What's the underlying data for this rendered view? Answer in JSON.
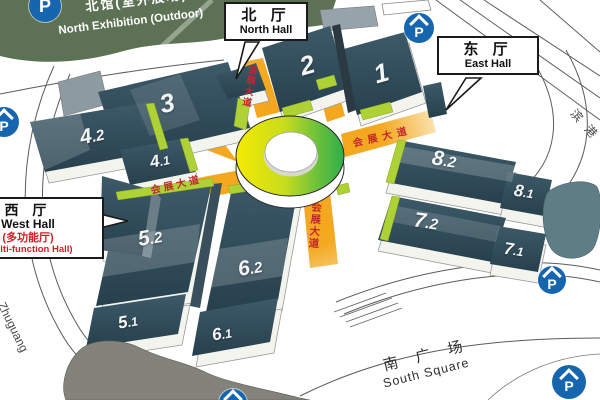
{
  "areas": {
    "north_outdoor": {
      "cn": "北馆(室外展场)",
      "en": "North Exhibition (Outdoor)"
    },
    "south_square": {
      "cn": "南 广 场",
      "en": "South Square"
    }
  },
  "callouts": {
    "north": {
      "cn": "北 厅",
      "en": "North Hall"
    },
    "east": {
      "cn": "东 厅",
      "en": "East Hall"
    },
    "west": {
      "cn": "西 厅",
      "en": "West Hall",
      "note_cn": "(多功能厅)",
      "note_en": "(Multi-function Hall)"
    }
  },
  "halls": [
    {
      "main": "1",
      "sub": ""
    },
    {
      "main": "2",
      "sub": ""
    },
    {
      "main": "3",
      "sub": ""
    },
    {
      "main": "4",
      "sub": ".2"
    },
    {
      "main": "4",
      "sub": ".1"
    },
    {
      "main": "5",
      "sub": ".2"
    },
    {
      "main": "5",
      "sub": ".1"
    },
    {
      "main": "6",
      "sub": ".2"
    },
    {
      "main": "6",
      "sub": ".1"
    },
    {
      "main": "7",
      "sub": ".2"
    },
    {
      "main": "7",
      "sub": ".1"
    },
    {
      "main": "8",
      "sub": ".2"
    },
    {
      "main": "8",
      "sub": ".1"
    }
  ],
  "roads": {
    "avenue": "会展大道",
    "binggang": "滨港",
    "zhuguang": "Zhuguang"
  },
  "icons": {
    "parking": "P"
  },
  "colors": {
    "hall_dark": "#2e4a56",
    "avenue_orange": "#f3a519",
    "avenue_text_red": "#c0272d",
    "green_area": "#5d7254",
    "entrance_green": "#aed136",
    "parking_blue": "#1565af",
    "ring_yellow": "#f2e600",
    "ring_green": "#2fae4a"
  }
}
